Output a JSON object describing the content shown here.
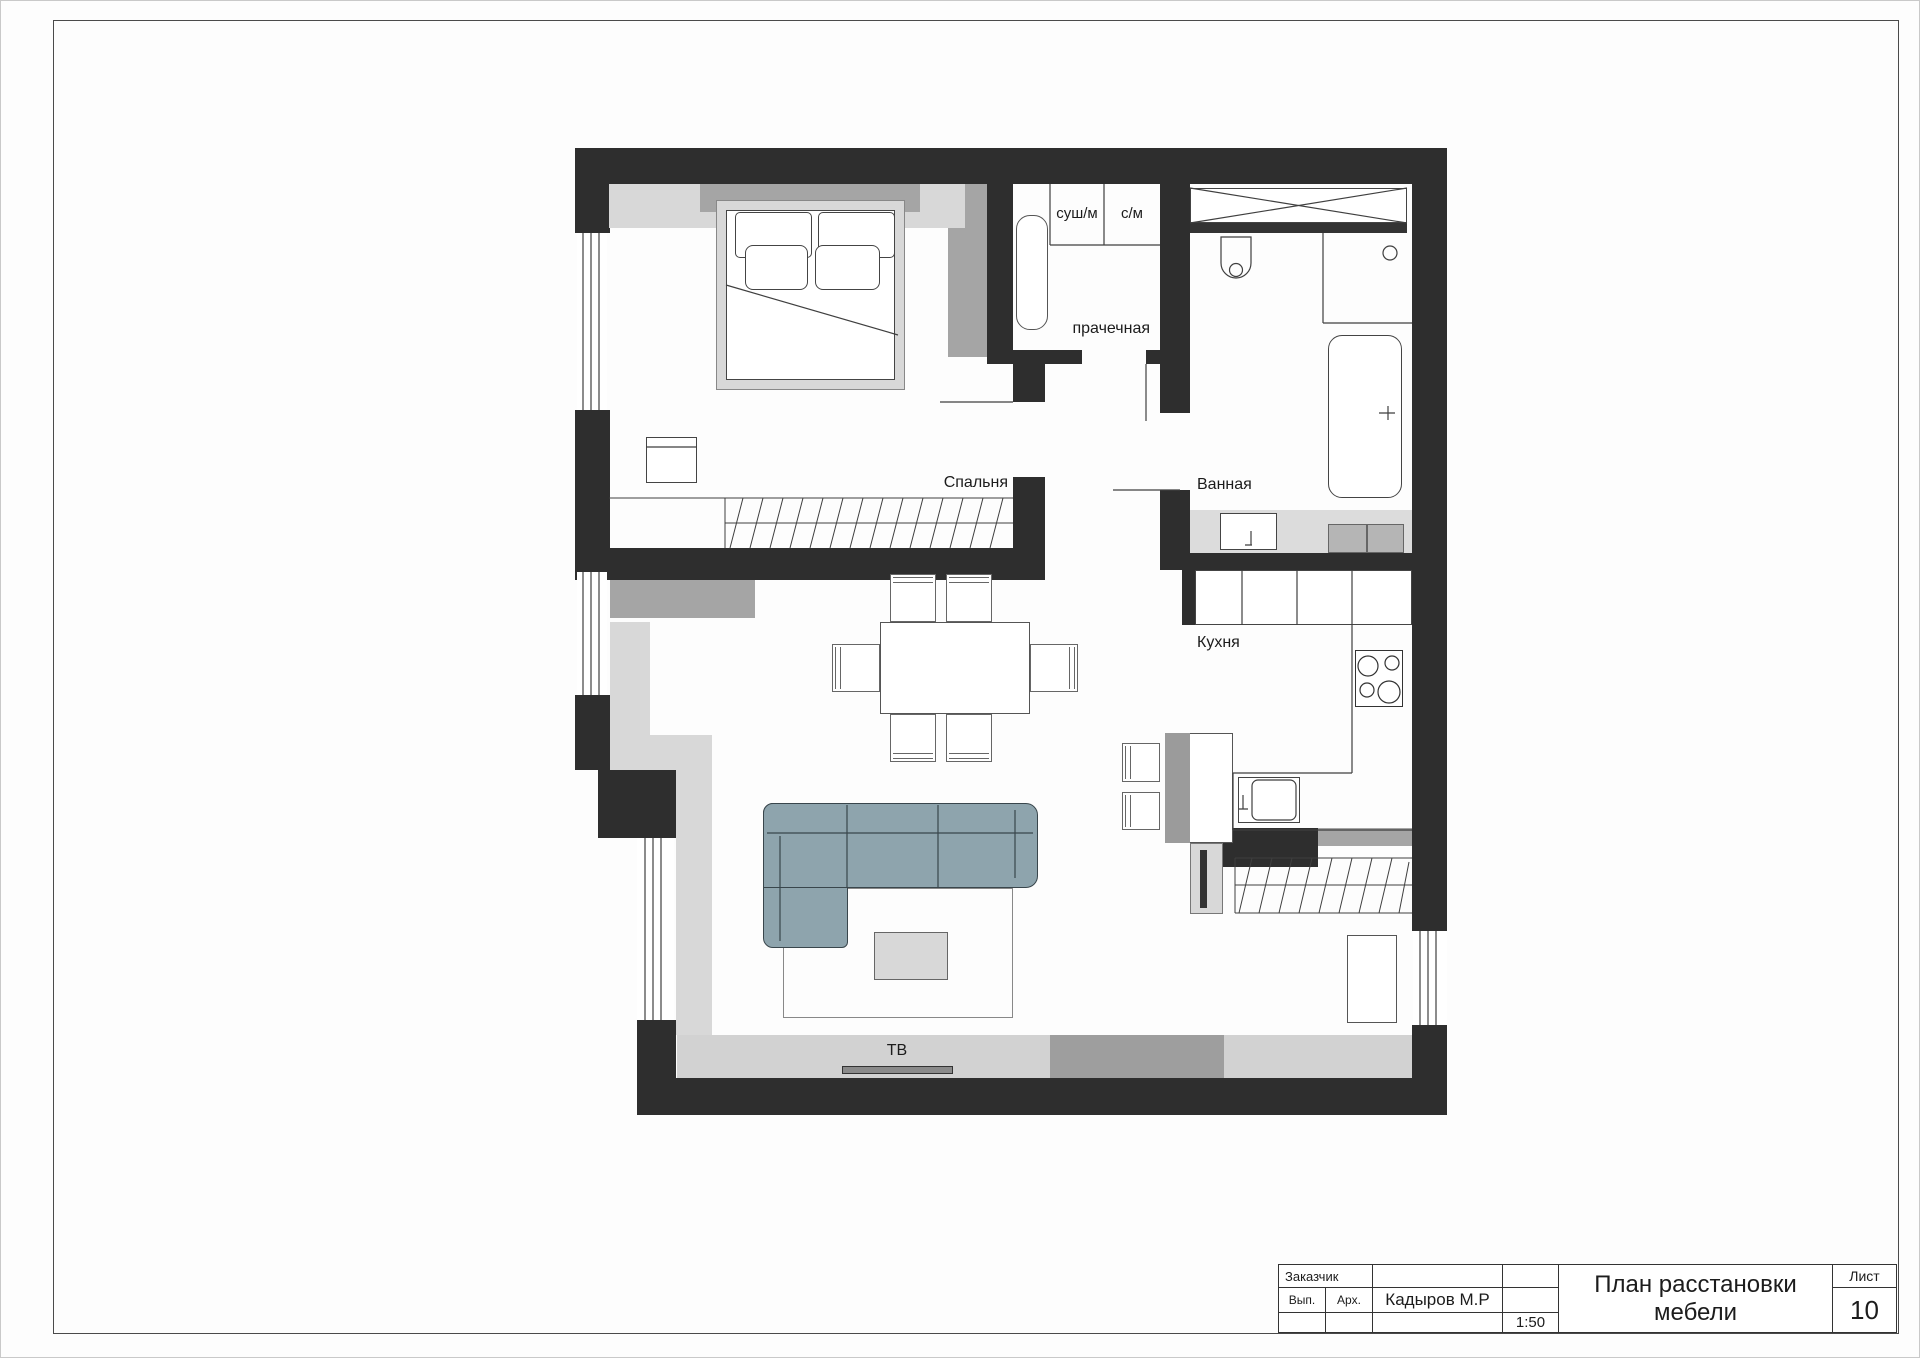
{
  "sheet": {
    "customer_label": "Заказчик",
    "exec_label": "Вып.",
    "arch_label": "Арх.",
    "architect_name": "Кадыров М.Р",
    "drawing_title": "План расстановки мебели",
    "scale": "1:50",
    "sheet_label": "Лист",
    "sheet_number": "10"
  },
  "plan": {
    "labels": {
      "bedroom": "Спальня",
      "bathroom": "Ванная",
      "kitchen": "Кухня",
      "laundry": "прачечная",
      "dryer": "суш/м",
      "washer": "с/м",
      "tv": "ТВ"
    },
    "colors": {
      "wall": "#2e2e2e",
      "light_gray": "#d8d8d8",
      "medium_gray": "#a5a5a5",
      "sofa": "#8ea4ad"
    }
  }
}
